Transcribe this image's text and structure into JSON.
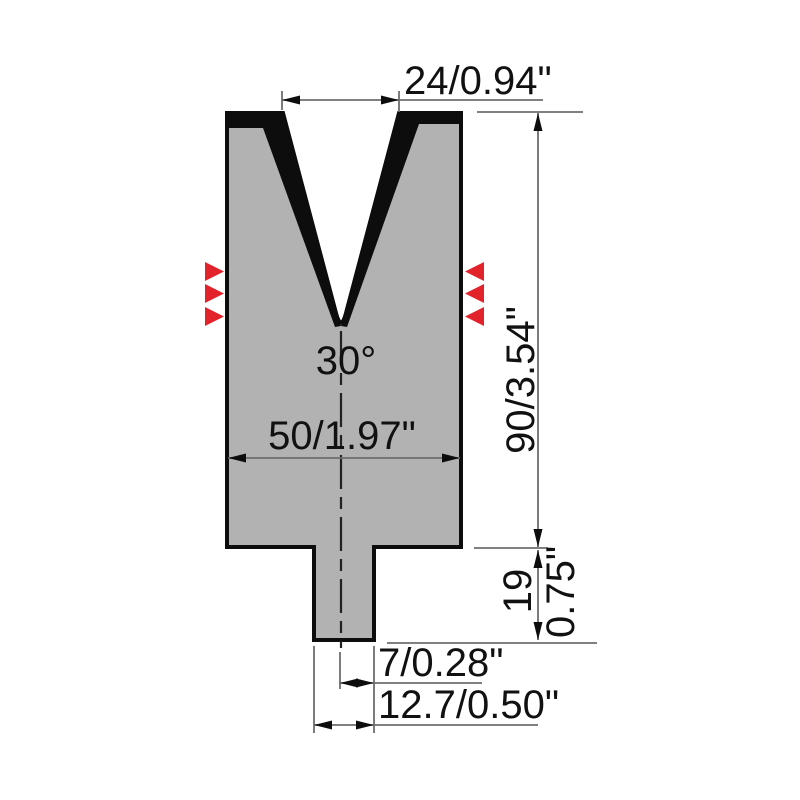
{
  "drawing": {
    "type": "press-brake V-die cross-section, 2D technical drawing",
    "labels": {
      "v_opening": "24/0.94\"",
      "v_angle": "30°",
      "body_width": "50/1.97\"",
      "body_height": "90/3.54\"",
      "tang_height_mm": "19",
      "tang_height_in": "0.75\"",
      "tang_half_width": "7/0.28\"",
      "tang_width": "12.7/0.50\""
    },
    "colors": {
      "die_fill": "#b2b2b2",
      "outline": "#0d0d0d",
      "marker_red": "#e2232b",
      "dim_line": "#6e6e6e",
      "centerline": "#222222",
      "text": "#111111"
    }
  }
}
